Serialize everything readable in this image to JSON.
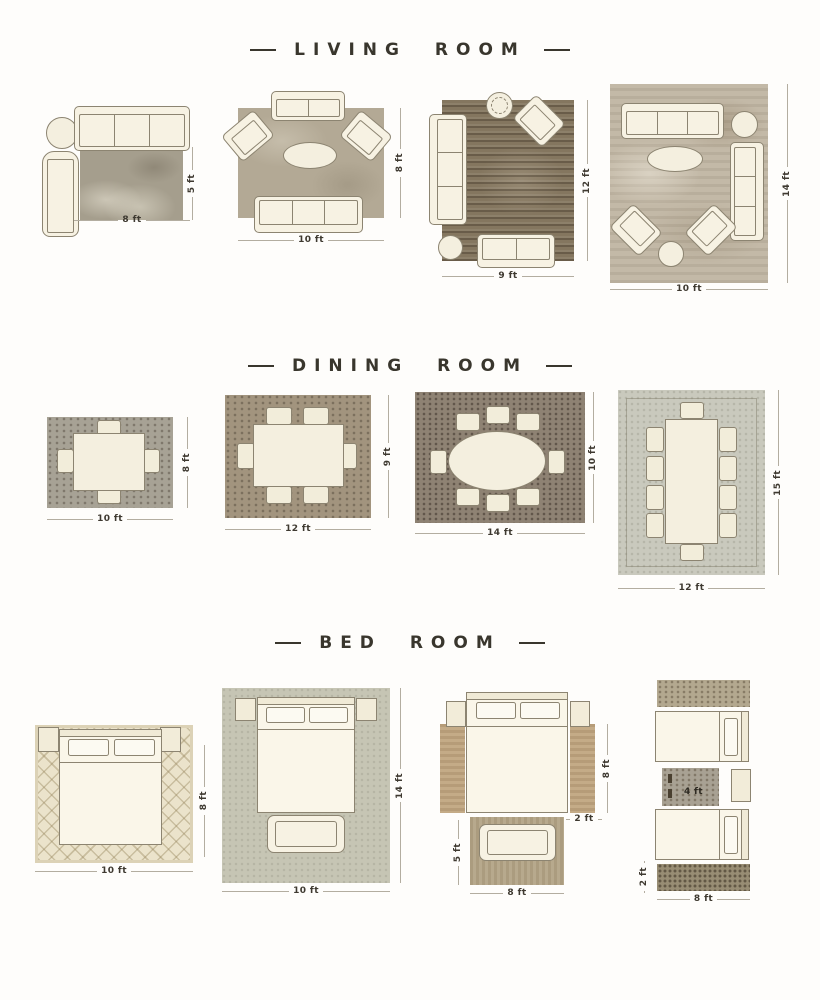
{
  "palette": {
    "background": "#fefdfb",
    "title_color": "#39362d",
    "dimension_text_color": "#3e3930",
    "dimension_line_color": "#b3ada0",
    "furniture_fill": "#f7f2e3",
    "furniture_outline": "#8c8471"
  },
  "sections": [
    {
      "id": "living-room",
      "title": "LIVING ROOM",
      "layouts": [
        {
          "width_label": "8 ft",
          "height_label": "5 ft",
          "furniture": [
            "sofa",
            "chaise-chair",
            "round-side-table",
            "rug"
          ]
        },
        {
          "width_label": "10 ft",
          "height_label": "8 ft",
          "furniture": [
            "loveseat",
            "armchair",
            "armchair",
            "oval-coffee-table",
            "sofa",
            "rug"
          ]
        },
        {
          "width_label": "9 ft",
          "height_label": "12 ft",
          "furniture": [
            "sofa",
            "plant",
            "armchair",
            "round-side-table",
            "bench",
            "rug"
          ]
        },
        {
          "width_label": "10 ft",
          "height_label": "14 ft",
          "furniture": [
            "sofa",
            "round-side-table",
            "sofa",
            "oval-coffee-table",
            "armchair",
            "armchair",
            "round-side-table",
            "rug"
          ]
        }
      ]
    },
    {
      "id": "dining-room",
      "title": "DINING ROOM",
      "layouts": [
        {
          "width_label": "10 ft",
          "height_label": "8 ft",
          "furniture": [
            "dining-table",
            "4-chairs",
            "rug"
          ]
        },
        {
          "width_label": "12 ft",
          "height_label": "9 ft",
          "furniture": [
            "dining-table",
            "6-chairs",
            "rug"
          ]
        },
        {
          "width_label": "14 ft",
          "height_label": "10 ft",
          "furniture": [
            "oval-dining-table",
            "8-chairs",
            "rug"
          ]
        },
        {
          "width_label": "12 ft",
          "height_label": "15 ft",
          "furniture": [
            "dining-table",
            "10-chairs",
            "rug"
          ]
        }
      ]
    },
    {
      "id": "bed-room",
      "title": "BED ROOM",
      "layouts": [
        {
          "width_label": "10 ft",
          "height_label": "8 ft",
          "furniture": [
            "bed",
            "nightstand",
            "nightstand",
            "patterned-rug"
          ]
        },
        {
          "width_label": "10 ft",
          "height_label": "14 ft",
          "furniture": [
            "bed",
            "nightstand",
            "nightstand",
            "bench",
            "rug"
          ]
        },
        {
          "bottom_width_label": "8 ft",
          "runner_height_label": "8 ft",
          "runner_width_label": "2 ft",
          "foot_rug_height_label": "5 ft",
          "furniture": [
            "bed",
            "nightstand",
            "nightstand",
            "runner-rug",
            "runner-rug",
            "foot-rug",
            "bench"
          ]
        },
        {
          "bottom_width_label": "8 ft",
          "runner_width_label": "2 ft",
          "center_rug_label": "4 ft",
          "furniture": [
            "runner-rug",
            "twin-bed",
            "accent-rug",
            "nightstand",
            "twin-bed",
            "runner-rug"
          ]
        }
      ]
    }
  ]
}
